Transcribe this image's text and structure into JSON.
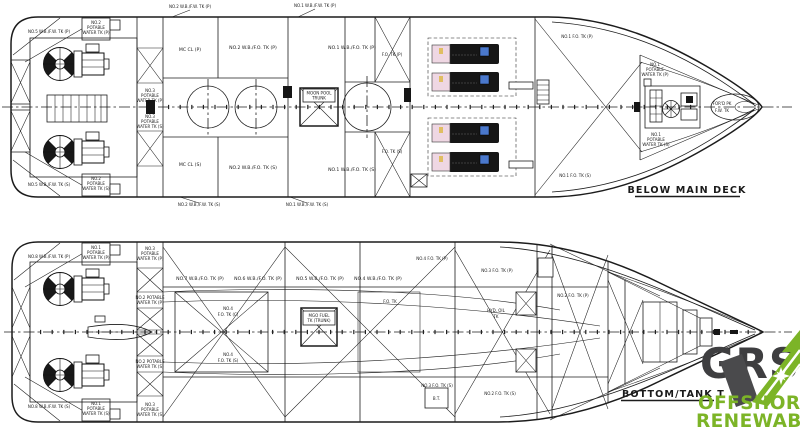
{
  "colors": {
    "line": "#1c1c1c",
    "genset_body": "#161616",
    "genset_pink": "#efd7e3",
    "genset_blue": "#4a78cc",
    "genset_yellow": "#e0be62",
    "logo_green": "#7cb427",
    "logo_dark": "#3e3e40"
  },
  "top_plan": {
    "caption": "BELOW MAIN DECK",
    "labels": {
      "above": [
        "NO.2 W.B./F.W. TK (P)",
        "NO.1 W.B./F.W. TK (P)"
      ],
      "below": [
        "NO.2 W.B./F.W. TK (S)",
        "NO.1 W.B./F.W. TK (S)"
      ],
      "stern_port": "NO.5 W.B./F.W. TK (P)",
      "stern_stbd": "NO.5 W.B./F.W. TK (S)",
      "potable_aft_port": [
        "NO.2",
        "POTABLE",
        "WATER TK (P)"
      ],
      "potable_aft_stbd": [
        "NO.2",
        "POTABLE",
        "WATER TK (S)"
      ],
      "frame_port": [
        "NO.3",
        "POTABLE",
        "WATER TK (P)"
      ],
      "frame_stbd": [
        "NO.3",
        "POTABLE",
        "WATER TK (S)"
      ],
      "rooms_port": [
        "MC CL (P)",
        "NO.2 W.B./F.O. TK (P)",
        "NO.1 W.B./F.O. TK (P)",
        "F.O. TK (P)"
      ],
      "rooms_stbd": [
        "MC CL (S)",
        "NO.2 W.B./F.O. TK (S)",
        "NO.1 W.B./F.O. TK (S)",
        "F.O. TK (S)"
      ],
      "moon_pool": [
        "MOON POOL",
        "TRUNK"
      ],
      "fo_bow_port": "NO.1 F.O. TK (P)",
      "fo_bow_stbd": "NO.1 F.O. TK (S)",
      "potable_fwd_port": [
        "NO.1",
        "POTABLE",
        "WATER TK (P)"
      ],
      "potable_fwd_stbd": [
        "NO.1",
        "POTABLE",
        "WATER TK (S)"
      ],
      "fore_peak": [
        "FOR'D PK",
        "F.W. TK"
      ]
    }
  },
  "bottom_plan": {
    "caption": "BOTTOM/TANK T",
    "labels": {
      "stern_port": "NO.8 W.B./F.W. TK (P)",
      "stern_stbd": "NO.8 W.B./F.W. TK (S)",
      "potable_aft_port": [
        "NO.1",
        "POTABLE",
        "WATER TK (P)"
      ],
      "potable_aft_stbd": [
        "NO.1",
        "POTABLE",
        "WATER TK (S)"
      ],
      "frame_labels": [
        [
          "NO.3",
          "POTABLE",
          "WATER TK (P)"
        ],
        [
          "NO.2 POTABLE",
          "WATER TK (P)"
        ],
        [
          "NO.2 POTABLE",
          "WATER TK (S)"
        ],
        [
          "NO.3",
          "POTABLE",
          "WATER TK (S)"
        ]
      ],
      "tanks_port": [
        "NO.7 W.B./F.O. TK (P)",
        "NO.6 W.B./F.O. TK (P)",
        "NO.5 W.B./F.O. TK (P)",
        "NO.4 W.B./F.O. TK (P)",
        "NO.4 F.O. TK (P)",
        "NO.3 F.O. TK (P)",
        "NO.2 F.O. TK (P)"
      ],
      "tanks_stbd": [
        "NO.3 F.O. TK (S)",
        "NO.2 F.O. TK (S)"
      ],
      "center_tank": [
        "NO.4",
        "F.O. TK (C)"
      ],
      "center_tank_s": [
        "NO.4",
        "F.O. TK (S)"
      ],
      "mgo_trunk": [
        "MGO FUEL",
        "TK (TRUNK)"
      ],
      "hyd_oil": [
        "HYD. OIL",
        "TK"
      ],
      "mid_small": "F.O. TK",
      "bow_thruster": "B.T.",
      "fore_peak": "F.P. TK"
    }
  },
  "logo": {
    "brand": "GRS",
    "tagline": [
      "OFFSHORE",
      "RENEWABLES"
    ]
  }
}
